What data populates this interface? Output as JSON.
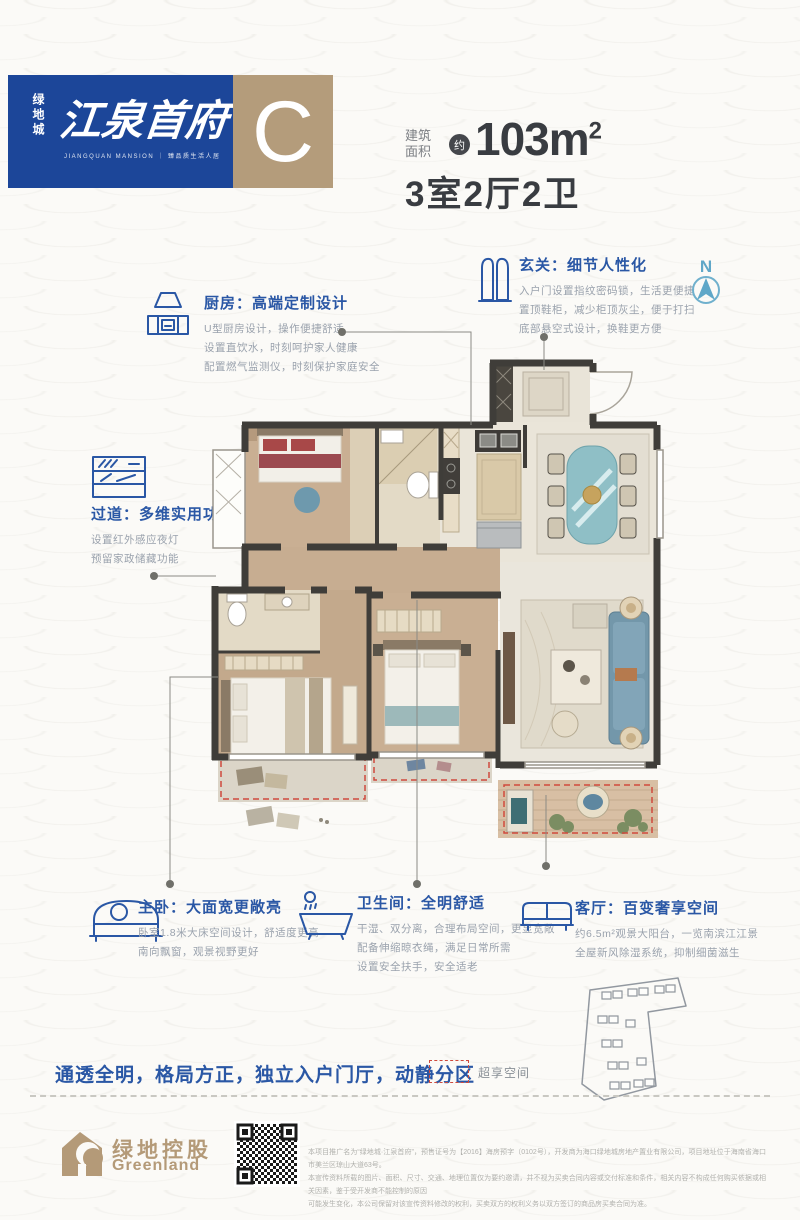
{
  "banner": {
    "brand_vertical": "绿地城",
    "project_name": "江泉首府",
    "project_sub": "JIANGQUAN MANSION ｜ 臻品质生活人居",
    "unit_letter": "C"
  },
  "area": {
    "label_line1": "建筑",
    "label_line2": "面积",
    "approx_badge": "约",
    "value": "103m",
    "value_sup": "2",
    "layout": "3室2厅2卫"
  },
  "compass": {
    "label": "N"
  },
  "annotations": {
    "kitchen": {
      "title": "厨房：高端定制设计",
      "lines": [
        "U型厨房设计，操作便捷舒适",
        "设置直饮水，时刻呵护家人健康",
        "配置燃气监测仪，时刻保护家庭安全"
      ]
    },
    "entry": {
      "title": "玄关：细节人性化",
      "lines": [
        "入户门设置指纹密码锁，生活更便捷",
        "置顶鞋柜，减少柜顶灰尘，便于打扫",
        "底部悬空式设计，换鞋更方便"
      ]
    },
    "corridor": {
      "title": "过道：多维实用功能",
      "lines": [
        "设置红外感应夜灯",
        "预留家政储藏功能"
      ]
    },
    "master": {
      "title": "主卧：大面宽更敞亮",
      "lines": [
        "卧室1.8米大床空间设计，舒适度更高",
        "南向飘窗，观景视野更好"
      ]
    },
    "bathroom": {
      "title": "卫生间：全明舒适",
      "lines": [
        "干湿、双分离，合理布局空间，更显宽敞",
        "配备伸缩晾衣绳，满足日常所需",
        "设置安全扶手，安全适老"
      ]
    },
    "living": {
      "title": "客厅：百变奢享空间",
      "lines": [
        "约6.5m²观景大阳台，一览南滨江江景",
        "全屋新风除湿系统，抑制细菌滋生"
      ]
    }
  },
  "footer": {
    "tagline": "通透全明，格局方正，独立入户门厅，动静分区",
    "legend_label": "超享空间",
    "logo_cn": "绿地控股",
    "logo_en": "Greenland",
    "disclaimer_lines": [
      "本项目推广名为“绿地城·江泉首府”，预售证号为【2016】海房预字（0102号），开发商为海口绿地城房地产置业有限公司，项目地址位于海南省海口市美兰区琼山大道63号。",
      "本宣传资料所载的图片、面积、尺寸、交通、地理位置仅为要约邀请，并不视为买卖合同内容或交付标准和条件，相关内容不构成任何购买依据或相关因素，鉴于受开发商不能控制的原因",
      "可能发生变化，本公司保留对该宣传资料修改的权利，买卖双方的权利义务以双方签订的商品房买卖合同为准。"
    ]
  },
  "colors": {
    "banner_blue": "#1c4699",
    "banner_tan": "#b49c7b",
    "accent_blue": "#2a57a5",
    "body_gray": "#9aa2ad",
    "bonus_red": "#cf4a3d",
    "compass_blue": "#5fa7c8",
    "logo_tan": "#b49a78"
  }
}
